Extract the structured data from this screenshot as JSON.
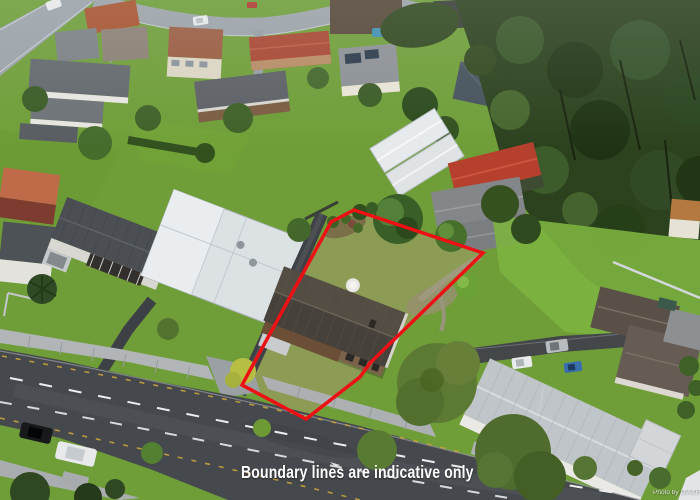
{
  "overlay": {
    "caption": "Boundary lines are indicative only",
    "watermark_credit": "Photo by DIAKRIT"
  },
  "boundary": {
    "stroke_color": "#ec1115",
    "stroke_width": "3.5",
    "polygon_points": "331,222 354,210 483,253 370,363 360,377 306,419 242,385"
  },
  "scene": {
    "description": "Aerial drone photo of a suburban neighbourhood; subject property with dark tiled roof and rear lawn outlined in red, wide road at lower left, dense bush at upper right",
    "colors": {
      "forest_green": "#2c421e",
      "lawn_green": "#6f9e38",
      "bright_lawn": "#7cb23f",
      "subject_lawn": "#8d9c55",
      "main_road": "#45484c",
      "suburb_road": "#9ba3a9",
      "subject_roof": "#46413a",
      "neighbor_red_roof": "#b5402e",
      "white_roof": "#dce1e4",
      "caption_text": "#ffffff"
    }
  }
}
